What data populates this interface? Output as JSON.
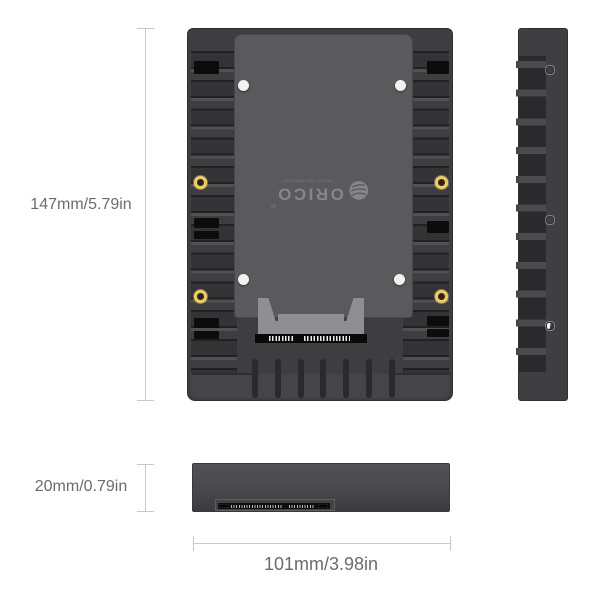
{
  "brand": {
    "name": "ORICO",
    "registered_mark": "®",
    "tagline": "ORICO TECHNOLOGY"
  },
  "dimension_labels": {
    "front_height": "147mm/5.79in",
    "side_thickness": "20mm/0.79in",
    "bottom_width": "101mm/3.98in"
  },
  "icons": {
    "screw_hole_gold": "gold-ring screw hole",
    "screw_hole_white": "white screw hole",
    "globe_logo": "globe"
  },
  "colors": {
    "background": "#ffffff",
    "body_dark": "#3e3e40",
    "plate_gray": "#5a5a5c",
    "cutout_black": "#0c0c0c",
    "screw_gold": "#f6cd4e",
    "screw_white": "#f2f2f2",
    "connector_gray": "#8f8f91",
    "dimension_line": "#c9c9c9",
    "dimension_text": "#6b6b6b",
    "logo_gray": "#86868a"
  }
}
